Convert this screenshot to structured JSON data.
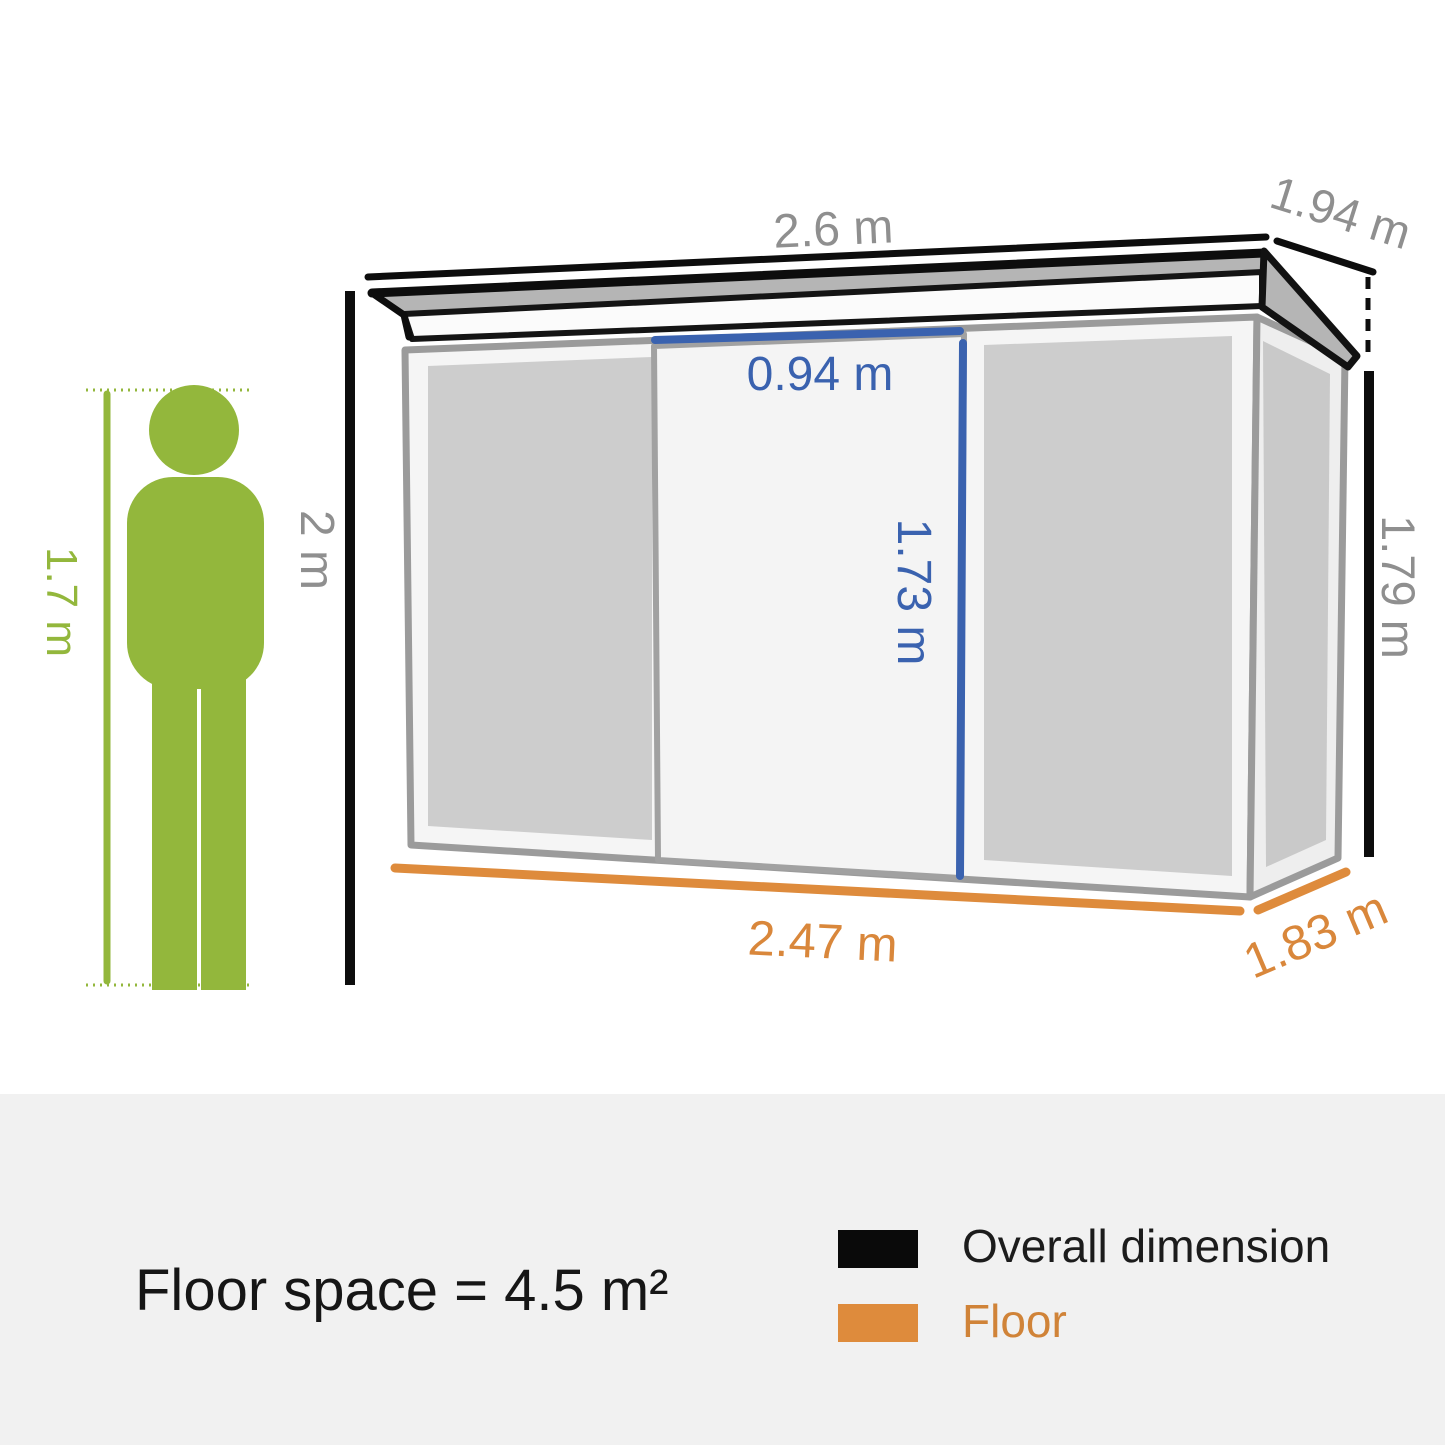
{
  "title": "Garden shed dimension diagram",
  "diagram": {
    "person": {
      "height_label": "1.7 m"
    },
    "overall": {
      "height_label": "2 m",
      "roof_width_label": "2.6 m",
      "roof_depth_label": "1.94 m",
      "right_wall_height_label": "1.79 m"
    },
    "door": {
      "width_label": "0.94 m",
      "height_label": "1.73 m"
    },
    "floor": {
      "width_label": "2.47 m",
      "depth_label": "1.83 m"
    }
  },
  "footer": {
    "floor_space_label": "Floor space = 4.5 m²",
    "legend": [
      {
        "label": "Overall dimension",
        "color": "#0a0a0a"
      },
      {
        "label": "Floor",
        "color": "#de8b3c"
      }
    ]
  },
  "colors": {
    "person_green": "#93b73c",
    "dimension_text_gray": "#8f8f8f",
    "door_blue": "#3a62af",
    "floor_orange": "#de8b3c",
    "overall_black": "#0d0d0d",
    "panel_gray": "#cdcdcd",
    "footer_band": "#f1f1f1"
  }
}
